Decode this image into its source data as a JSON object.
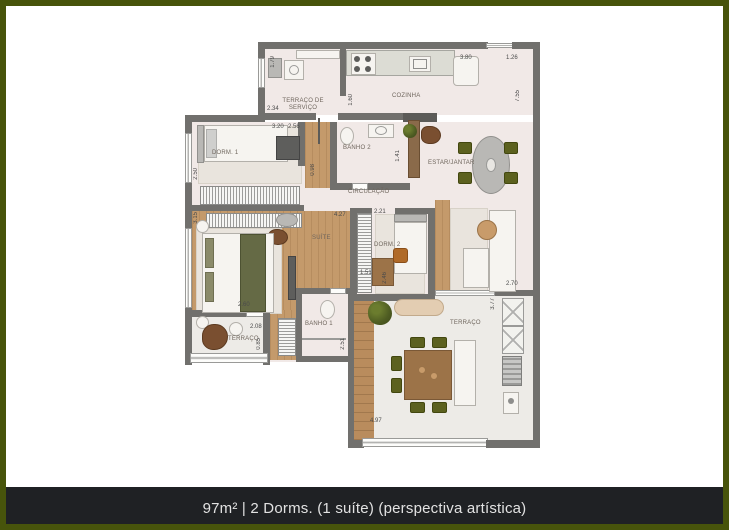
{
  "caption": "97m² | 2 Dorms. (1 suíte) (perspectiva artística)",
  "rooms": {
    "servico": "TERRAÇO DE SERVIÇO",
    "cozinha": "COZINHA",
    "estar": "ESTAR/JANTAR",
    "dorm1": "DORM. 1",
    "banho2": "BANHO 2",
    "circulacao": "CIRCULAÇÃO",
    "suite": "SUÍTE",
    "dorm2": "DORM. 2",
    "banho1": "BANHO 1",
    "terraco_suite": "TERRAÇO",
    "terraco_gourmet": "TERRAÇO"
  },
  "dimensions": {
    "servico_height": "1.79",
    "servico_width": "2.34",
    "servico_pass": "1.60",
    "cozinha_width": "3.80",
    "canto_width": "1.26",
    "estar_height": "7.55",
    "dorm1_width": "3.20",
    "dorm1_height": "2.50",
    "hall_width": "2.56",
    "banho2_height": "1.41",
    "circ_width": "0.98",
    "suite_width": "4.27",
    "suite_height": "3.15",
    "suite_lower_width": "2.60",
    "dorm2_width": "2.21",
    "dorm2_height": "2.46",
    "banho1_width": "1.51",
    "banho1_height": "2.51",
    "terraco_suite_width": "2.08",
    "terraco_suite_height": "0.85",
    "estar_width": "2.70",
    "terraco_gourmet_height": "3.77",
    "terraco_gourmet_width": "4.97"
  },
  "colors": {
    "frame_green": "#47540b",
    "caption_bg": "#1f2124",
    "wall_gray": "#71706d",
    "floor_pink": "#f1e9e7",
    "wood": "#c49a6b",
    "chair_olive": "#5c611f"
  }
}
